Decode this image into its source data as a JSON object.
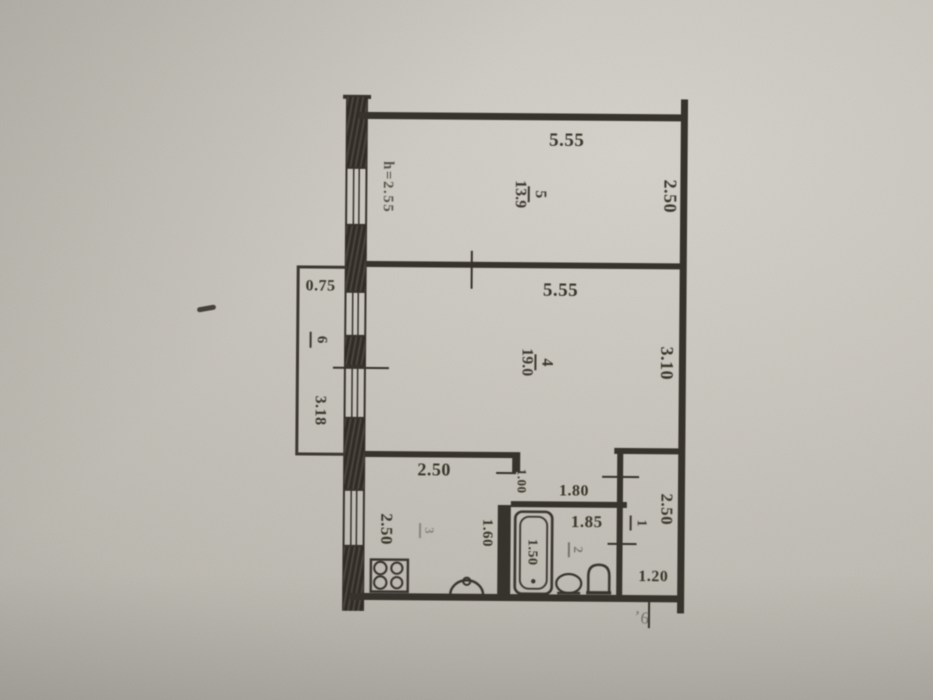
{
  "document_type": "apartment floor plan (photographed technical drawing)",
  "colors": {
    "paper": "#c7c3bb",
    "ink": "#35312a"
  },
  "rooms": {
    "room5": {
      "number": "5",
      "area": "13.9",
      "dim_top": "5.55",
      "dim_right": "2.50",
      "ceiling_note": "h=2.55"
    },
    "room4": {
      "number": "4",
      "area": "19.0",
      "dim_top": "5.55",
      "dim_right": "3.10"
    },
    "balcony": {
      "number": "6",
      "dim_top": "0.75",
      "dim_side": "3.18"
    },
    "kitchen": {
      "number": "3",
      "dim_top": "2.50",
      "dim_left": "2.50",
      "dim_inner": "1.60"
    },
    "bathroom": {
      "number": "2",
      "dim_top": "1.80",
      "dim_inner": "1.85",
      "dim_passage": "1.00",
      "dim_tub": "1.50"
    },
    "hallway": {
      "number": "1",
      "dim_side": "2.50",
      "dim_bottom": "1.20"
    }
  },
  "annotations": {
    "handwritten_note": "’6"
  },
  "fixtures": [
    "stove-icon",
    "kitchen-sink-icon",
    "bathtub-icon",
    "washbasin-icon",
    "toilet-icon",
    "vent-shaft"
  ]
}
